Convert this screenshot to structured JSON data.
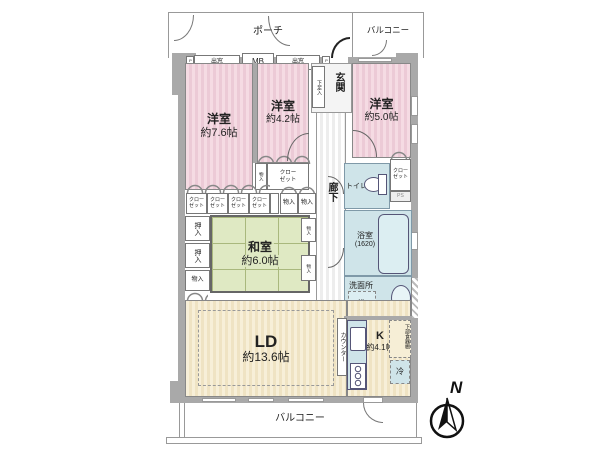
{
  "colors": {
    "wall": "#a9a9a9",
    "pink": "#f3d7e0",
    "green": "#dfe9c3",
    "cream": "#f6eed6",
    "blue": "#cfe4e9"
  },
  "outdoor": {
    "porch": "ポーチ",
    "balcony_top": "バルコニー",
    "balcony_bottom": "バルコニー"
  },
  "fixtures": {
    "bay_window": "出窓",
    "meter_box": "MB",
    "ps": "PS"
  },
  "entrance": {
    "hall": "玄関",
    "shoe_cabinet": "下足入"
  },
  "corridor": {
    "label": "廊下"
  },
  "rooms": {
    "western_76": {
      "name": "洋室",
      "size": "約7.6帖"
    },
    "western_42": {
      "name": "洋室",
      "size": "約4.2帖"
    },
    "western_50": {
      "name": "洋室",
      "size": "約5.0帖"
    },
    "japanese_60": {
      "name": "和室",
      "size": "約6.0帖"
    },
    "living_dining": {
      "name": "LD",
      "size": "約13.6帖"
    },
    "kitchen": {
      "name": "K",
      "size": "約4.1帖"
    }
  },
  "storage": {
    "closet": "クロー\nゼット",
    "monoire": "物入",
    "oshiire": "押入"
  },
  "wet_areas": {
    "bath": "浴室",
    "bath_size": "(1620)",
    "washroom": "洗面所",
    "washing_machine": "洗",
    "toilet": "トイレ"
  },
  "kitchen_fixtures": {
    "counter": "カウンター",
    "lower_cupboard": "下部食器棚",
    "refrigerator": "冷"
  },
  "compass": {
    "north": "N"
  }
}
